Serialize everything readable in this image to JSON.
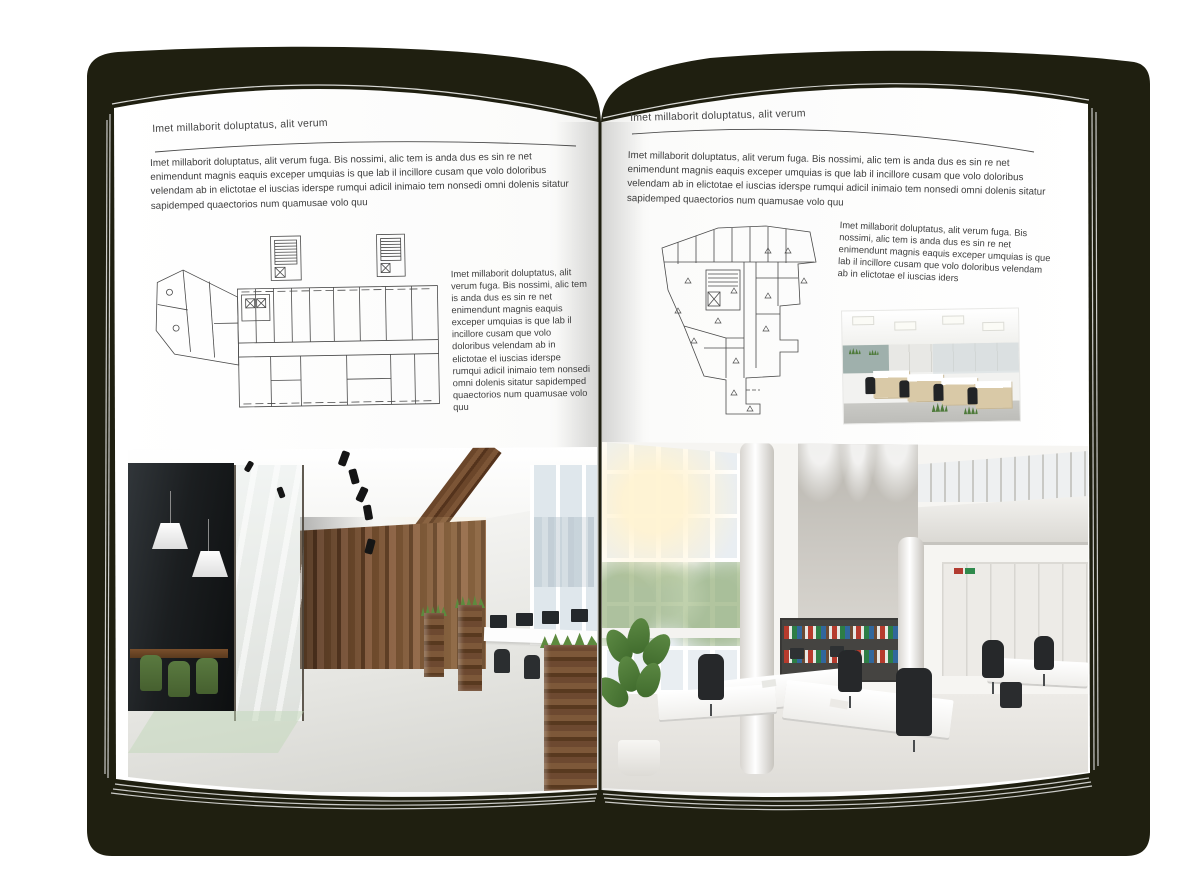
{
  "left_page": {
    "header": "Imet millaborit doluptatus, alit verum",
    "intro": "Imet millaborit doluptatus, alit verum fuga. Bis nossimi, alic tem is anda dus es sin re net enimendunt magnis eaquis exceper umquias is que lab il incillore cusam que volo doloribus velendam ab in elictotae el iuscias iderspe rumqui adicil inimaio tem nonsedi omni dolenis sitatur sapidemped quaectorios num quamusae volo quu",
    "caption": "Imet millaborit doluptatus, alit verum fuga. Bis nossimi, alic tem is anda dus es sin re net enimendunt magnis eaquis exceper umquias is que lab il incillore cusam que volo doloribus velendam ab in elictotae el iuscias iderspe rumqui adicil inimaio tem nonsedi omni dolenis sitatur sapidemped quaectorios num quamusae volo quu"
  },
  "right_page": {
    "header": "Imet millaborit doluptatus, alit verum",
    "intro": "Imet millaborit doluptatus, alit verum fuga. Bis nossimi, alic tem is anda dus es sin re net enimendunt magnis eaquis exceper umquias is que lab il incillore cusam que volo doloribus velendam ab in elictotae el iuscias iderspe rumqui adicil inimaio tem nonsedi omni dolenis sitatur sapidemped quaectorios num quamusae volo quu",
    "caption": "Imet millaborit doluptatus, alit verum fuga. Bis nossimi, alic tem is anda dus es sin re net enimendunt magnis eaquis exceper umquias is que lab il incillore cusam que volo doloribus velendam ab in elictotae el iuscias iders"
  },
  "palette": {
    "cover": "#1f1f10",
    "page": "#ffffff",
    "text": "#3e3e3e",
    "plan_line": "#4a4a4a",
    "wood": "#6e4a2d",
    "meeting_room_glass": "#1b1e20",
    "chair_green": "#50703a",
    "plant_green": "#4e7a3a",
    "binder_red": "#b63b2d",
    "binder_green": "#2d7d46",
    "binder_blue": "#31679c",
    "concrete": "#c2bfb8"
  }
}
